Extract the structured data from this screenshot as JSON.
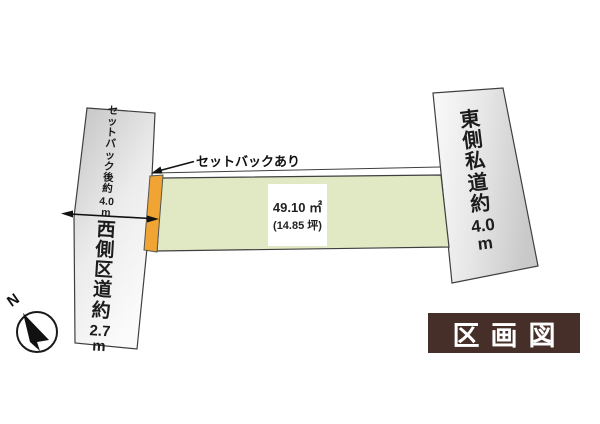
{
  "figure": {
    "badge_label": "区画図",
    "compass_n": "N",
    "parcel": {
      "area_sqm": "49.10 ㎡",
      "area_tsubo": "(14.85 坪)"
    },
    "setback_callout": "セットバックあり",
    "west_road_setback": {
      "label": "セットバック後約",
      "value": "4.0",
      "unit": "m"
    },
    "west_road": {
      "label": "西側区道約",
      "value": "2.7",
      "unit": "m"
    },
    "east_road": {
      "label": "東側私道約",
      "value": "4.0",
      "unit": "m"
    },
    "colors": {
      "parcel_green": "#e0e8c4",
      "setback_orange": "#efa434",
      "badge_brown": "#462f28",
      "road_gray": "#d6d6d6"
    }
  }
}
